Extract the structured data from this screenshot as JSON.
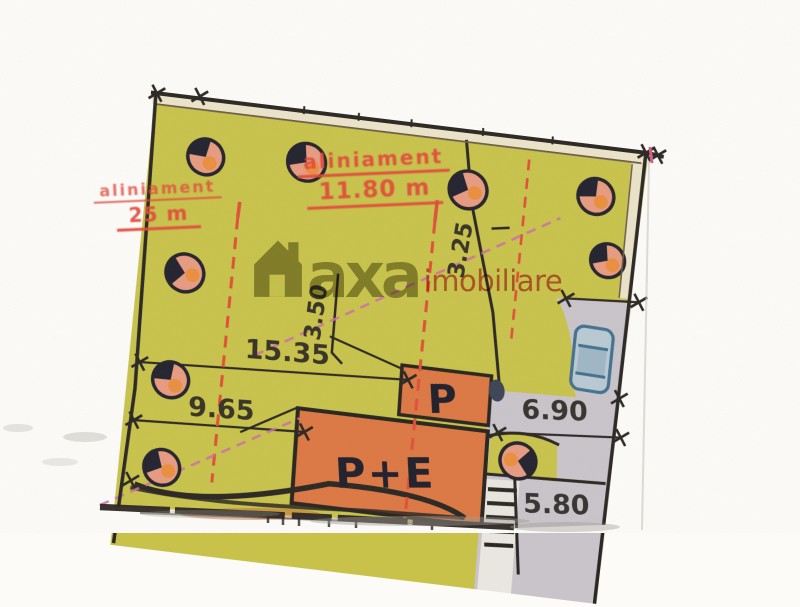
{
  "watermark": {
    "brand": "axa",
    "suffix": "imobiliare"
  },
  "stamps": {
    "top": {
      "word": "aliniament",
      "value": "11.80 m"
    },
    "left": {
      "word": "aliniament",
      "value": "25 m"
    }
  },
  "buildings": {
    "p": "P",
    "pe": "P+E"
  },
  "dimensions": {
    "front": "15.35",
    "side": "9.65",
    "access": "6.90",
    "back": "5.80",
    "offset_a": "3.50",
    "offset_b": "3.25"
  },
  "colors": {
    "parcel_fill": "#c8c24b",
    "building_fill": "#dc7843",
    "driveway_fill": "#c8c4ca",
    "stamp_red": "#e2493a",
    "ink": "#2b2722",
    "car_blue": "#44718f"
  }
}
